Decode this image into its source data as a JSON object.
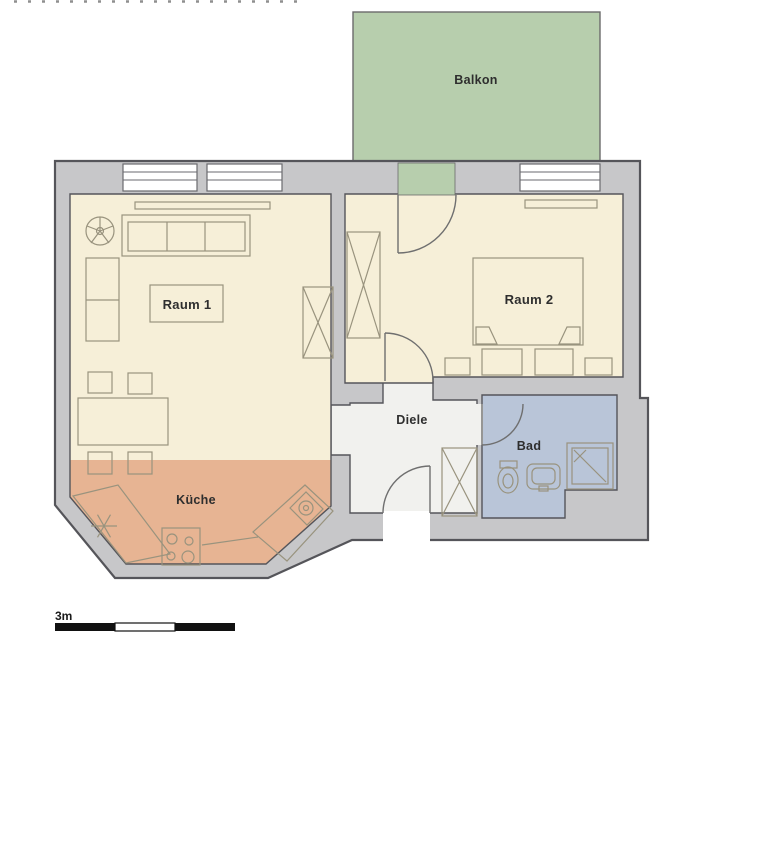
{
  "plan": {
    "rooms": {
      "balkon": {
        "label": "Balkon",
        "color": "#b7cead"
      },
      "raum1": {
        "label": "Raum 1",
        "color": "#f6efd8"
      },
      "raum2": {
        "label": "Raum 2",
        "color": "#f6efd8"
      },
      "kueche": {
        "label": "Küche",
        "color": "#e7b493"
      },
      "diele": {
        "label": "Diele",
        "color": "#f1f1ee"
      },
      "bad": {
        "label": "Bad",
        "color": "#b9c5d8"
      }
    },
    "scale_bar": {
      "label": "3m"
    },
    "palette": {
      "wall_fill": "#c7c7c9",
      "wall_line": "#55555a",
      "furniture_line": "#99937e",
      "window_fill": "#ffffff",
      "door_line": "#6f6f6f"
    }
  }
}
